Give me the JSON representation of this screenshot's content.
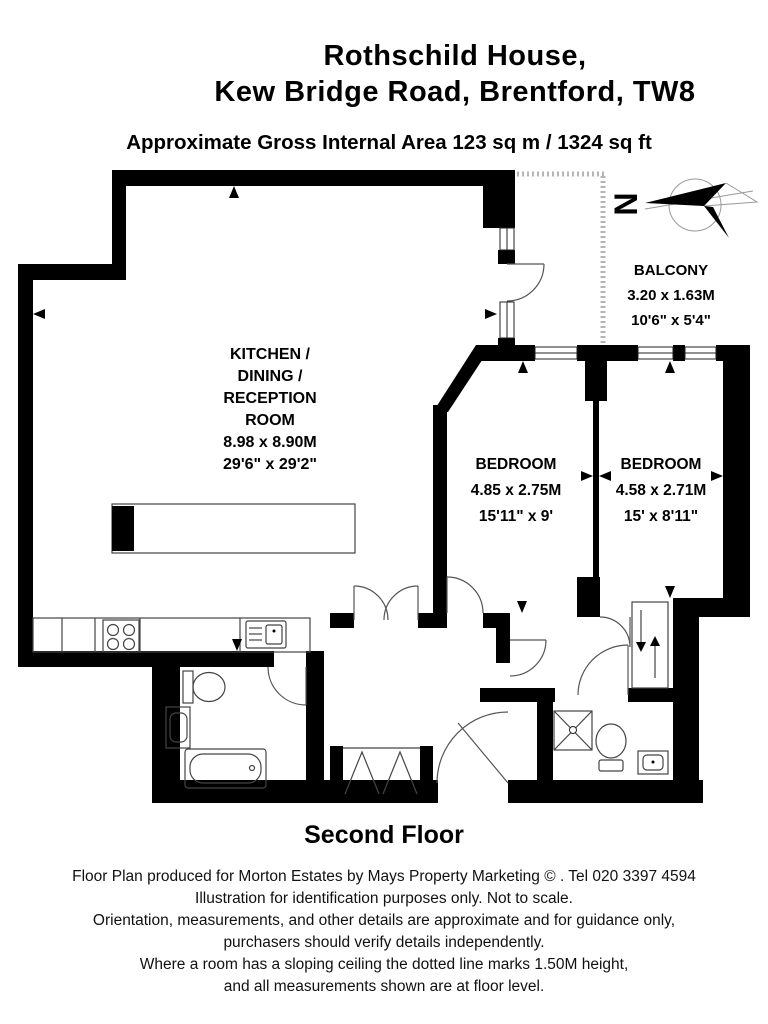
{
  "header": {
    "title_line1": "Rothschild House,",
    "title_line2": "Kew Bridge Road, Brentford, TW8",
    "area_line": "Approximate Gross Internal Area 123 sq m / 1324 sq ft"
  },
  "floor_plan": {
    "north_label": "N",
    "rooms": {
      "kitchen": {
        "name_line1": "KITCHEN /",
        "name_line2": "DINING /",
        "name_line3": "RECEPTION",
        "name_line4": "ROOM",
        "dim_metric": "8.98 x 8.90M",
        "dim_imperial": "29'6\" x 29'2\""
      },
      "bedroom1": {
        "name": "BEDROOM",
        "dim_metric": "4.85 x 2.75M",
        "dim_imperial": "15'11\" x 9'"
      },
      "bedroom2": {
        "name": "BEDROOM",
        "dim_metric": "4.58 x 2.71M",
        "dim_imperial": "15' x 8'11\""
      },
      "balcony": {
        "name": "BALCONY",
        "dim_metric": "3.20 x 1.63M",
        "dim_imperial": "10'6\" x 5'4\""
      }
    }
  },
  "floor_label": "Second Floor",
  "footer": {
    "line1": "Floor Plan produced for Morton Estates by Mays Property Marketing © . Tel 020 3397 4594",
    "line2": "Illustration for identification purposes only. Not to scale.",
    "line3": "Orientation, measurements, and other details are approximate and for guidance only,",
    "line4": "purchasers should verify details independently.",
    "line5": "Where a room has a sloping ceiling the dotted line marks 1.50M height,",
    "line6": "and all measurements shown are at floor level."
  },
  "colors": {
    "wall": "#000000",
    "balcony_outline": "#b5b5b5",
    "text": "#000000"
  }
}
